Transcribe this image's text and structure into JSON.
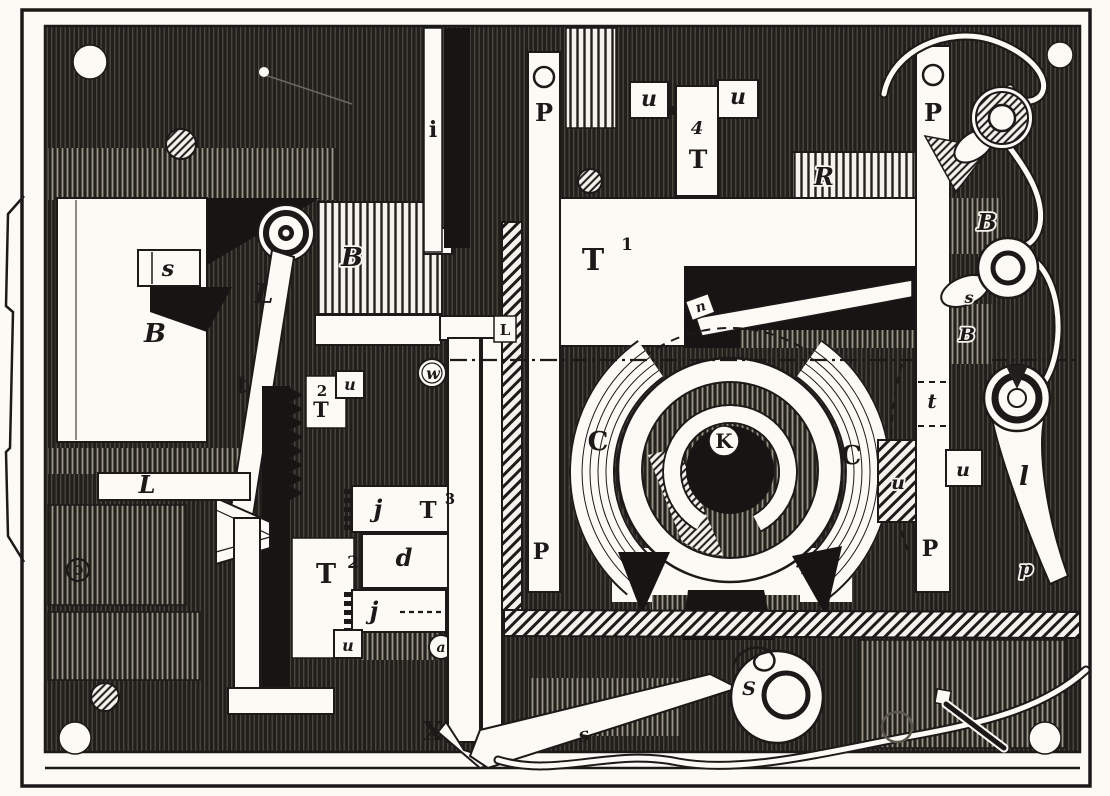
{
  "figure": {
    "type": "engraving",
    "description": "19th-century woodcut-style plan view of a telegraph-instrument mechanism mounted on a dark base plate",
    "colors": {
      "ink": "#1b1a18",
      "paper": "#fbfaf5"
    }
  },
  "labels": {
    "i_bar": "i",
    "p_left_top": "P",
    "p_left_bottom": "P",
    "u_top_left": "u",
    "u_top_right": "u",
    "t4_sup": "4",
    "t4_base": "T",
    "r_slide": "R",
    "t1_base": "T",
    "t1_sup": "1",
    "n_pivot": "n",
    "s_stop": "s",
    "b_magnet_left": "B",
    "l_lever": "L",
    "b_magnet_right": "B",
    "t_armature": "t",
    "u_mid_small": "u",
    "w_roller": "w",
    "t2_stack_sup": "2",
    "t2_stack_base": "T",
    "l_guide": "L",
    "l_mid_small": "L",
    "j_upper": "j",
    "t3_base": "T",
    "t3_sup": "3",
    "d_slide": "d",
    "t2_base": "T",
    "t2_sup": "2",
    "j_lower": "j",
    "u_bottom_box": "u",
    "a_pivot": "a",
    "x_slide": "X",
    "c_left": "C",
    "c_right": "C",
    "k_hub": "K",
    "s_lever_arm": "s",
    "s_lever_head": "S",
    "t_right": "t",
    "u_right_box": "u",
    "u_right_hatch": "u",
    "p_right_top": "P",
    "p_right_bottom": "P",
    "b_terminal_upper": "B",
    "s_terminal": "s",
    "b_terminal_lower": "B",
    "l_club": "l",
    "p_club": "p"
  }
}
